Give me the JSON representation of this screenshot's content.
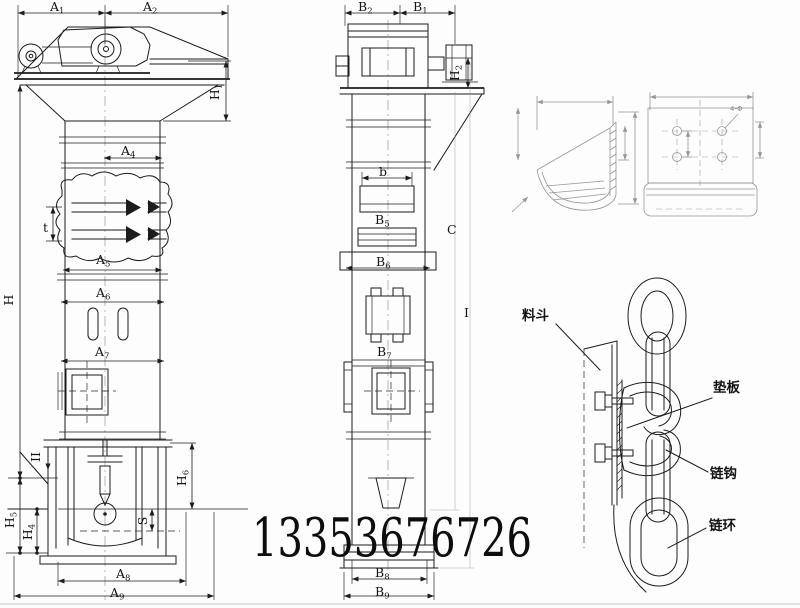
{
  "document": {
    "type": "technical engineering drawing",
    "subject": "chain bucket elevator general arrangement with bucket and chain attachment details",
    "watermark_phone": "13353676726"
  },
  "colors": {
    "ink": "#1c1c1c",
    "faint_detail": "#969696",
    "paper": "#fdfdfd"
  },
  "front_view": {
    "dims": {
      "a1": {
        "base": "A",
        "sub": "1"
      },
      "a2": {
        "base": "A",
        "sub": "2"
      },
      "h1": {
        "base": "H",
        "sub": "1"
      },
      "a4": {
        "base": "A",
        "sub": "4"
      },
      "t": {
        "base": "t",
        "sub": ""
      },
      "a5": {
        "base": "A",
        "sub": "5"
      },
      "a6": {
        "base": "A",
        "sub": "6"
      },
      "a7": {
        "base": "A",
        "sub": "7"
      },
      "h": {
        "base": "H",
        "sub": ""
      },
      "section_mark": {
        "base": "II",
        "sub": ""
      },
      "h5": {
        "base": "H",
        "sub": "5"
      },
      "h4": {
        "base": "H",
        "sub": "4"
      },
      "s": {
        "base": "S",
        "sub": ""
      },
      "h6": {
        "base": "H",
        "sub": "6"
      },
      "a8": {
        "base": "A",
        "sub": "8"
      },
      "a9": {
        "base": "A",
        "sub": "9"
      }
    }
  },
  "side_view": {
    "dims": {
      "b2": {
        "base": "B",
        "sub": "2"
      },
      "b1": {
        "base": "B",
        "sub": "1"
      },
      "h2": {
        "base": "H",
        "sub": "2"
      },
      "b": {
        "base": "b",
        "sub": ""
      },
      "b5": {
        "base": "B",
        "sub": "5"
      },
      "b6": {
        "base": "B",
        "sub": "6"
      },
      "c": {
        "base": "C",
        "sub": ""
      },
      "i": {
        "base": "I",
        "sub": ""
      },
      "b7": {
        "base": "B",
        "sub": "7"
      },
      "b8": {
        "base": "B",
        "sub": "8"
      },
      "b9": {
        "base": "B",
        "sub": "9"
      }
    }
  },
  "bucket_detail": {
    "bolt_hole_note": "4-Φ"
  },
  "chain_detail": {
    "labels": {
      "bucket": "料斗",
      "pad_plate": "垫板",
      "chain_hook": "链钩",
      "chain_link": "链环"
    }
  }
}
